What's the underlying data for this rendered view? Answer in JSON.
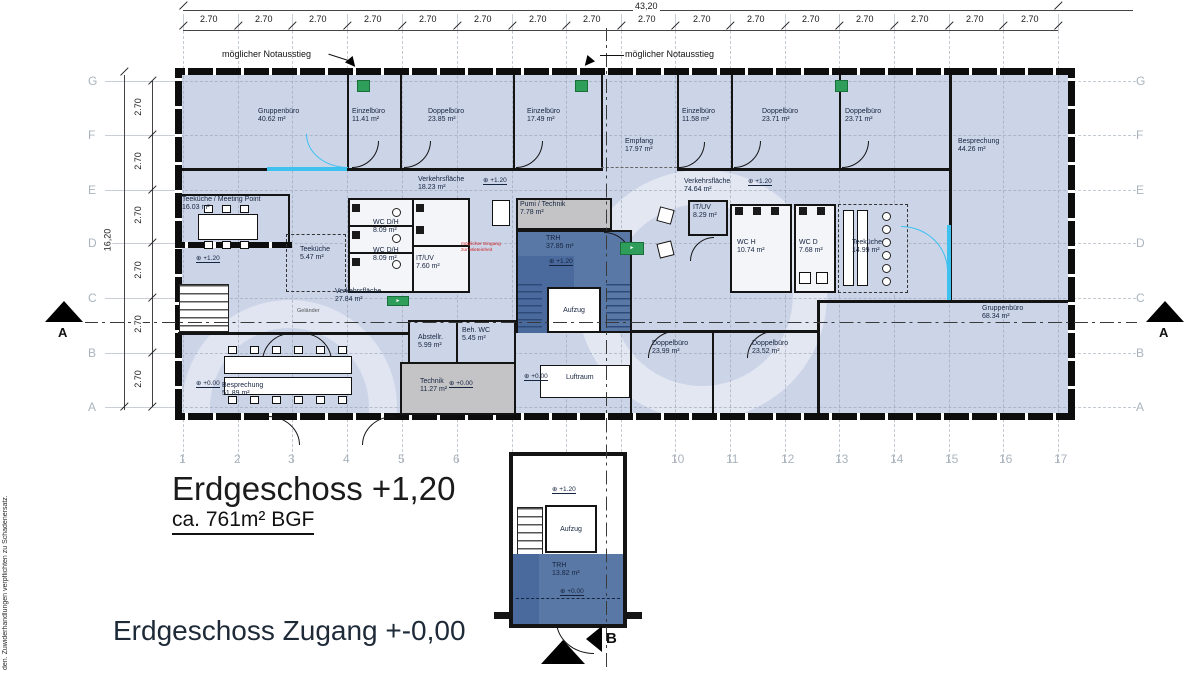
{
  "document": {
    "floor_title": "Erdgeschoss +1,20",
    "floor_area": "ca. 761m² BGF",
    "access_title": "Erdgeschoss Zugang +-0,00",
    "side_note": "den. Zuwiderhandlungen verpflichten zu Schadenersatz."
  },
  "dimensions": {
    "total_width": "43,20",
    "total_height": "16,20",
    "h_segment": "2.70",
    "h_segment_centers": [
      210,
      265,
      319,
      374,
      429,
      484,
      539,
      593,
      648,
      703,
      757,
      812,
      866,
      921,
      976,
      1031
    ],
    "v_segment": "2.70",
    "v_segment_centers": [
      108,
      162,
      216,
      271,
      325,
      380
    ]
  },
  "grid": {
    "cols": [
      {
        "label": "1",
        "x": 183
      },
      {
        "label": "2",
        "x": 238
      },
      {
        "label": "3",
        "x": 292
      },
      {
        "label": "4",
        "x": 347
      },
      {
        "label": "5",
        "x": 402
      },
      {
        "label": "6",
        "x": 457
      },
      {
        "label": "",
        "x": 512
      },
      {
        "label": "",
        "x": 566
      },
      {
        "label": "",
        "x": 621
      },
      {
        "label": "10",
        "x": 675
      },
      {
        "label": "11",
        "x": 730
      },
      {
        "label": "12",
        "x": 785
      },
      {
        "label": "13",
        "x": 839
      },
      {
        "label": "14",
        "x": 894
      },
      {
        "label": "15",
        "x": 949
      },
      {
        "label": "16",
        "x": 1003
      },
      {
        "label": "17",
        "x": 1058
      }
    ],
    "rows": [
      {
        "label": "G",
        "y": 81
      },
      {
        "label": "F",
        "y": 135
      },
      {
        "label": "E",
        "y": 190
      },
      {
        "label": "D",
        "y": 243
      },
      {
        "label": "C",
        "y": 298
      },
      {
        "label": "B",
        "y": 353
      },
      {
        "label": "A",
        "y": 407
      }
    ]
  },
  "annotations": {
    "emergency_exit": "möglicher Notausstieg",
    "entrance_note": "möglicher Eingang zur Mieteinheit",
    "railing": "Geländer"
  },
  "labels": {
    "elevator": "Aufzug"
  },
  "section_markers": {
    "left": "A",
    "right": "A",
    "bottom": "B"
  },
  "rooms": [
    {
      "name": "Gruppenbüro",
      "area": "40.62 m²",
      "x": 258,
      "y": 108
    },
    {
      "name": "Einzelbüro",
      "area": "11.41 m²",
      "x": 352,
      "y": 108
    },
    {
      "name": "Doppelbüro",
      "area": "23.85 m²",
      "x": 428,
      "y": 108
    },
    {
      "name": "Einzelbüro",
      "area": "17.49 m²",
      "x": 527,
      "y": 108
    },
    {
      "name": "Empfang",
      "area": "17.97 m²",
      "x": 625,
      "y": 138
    },
    {
      "name": "Einzelbüro",
      "area": "11.58 m²",
      "x": 682,
      "y": 108
    },
    {
      "name": "Doppelbüro",
      "area": "23.71 m²",
      "x": 762,
      "y": 108
    },
    {
      "name": "Doppelbüro",
      "area": "23.71 m²",
      "x": 845,
      "y": 108
    },
    {
      "name": "Besprechung",
      "area": "44.26 m²",
      "x": 958,
      "y": 138
    },
    {
      "name": "Verkehrsfläche",
      "area": "18.23 m²",
      "x": 418,
      "y": 176
    },
    {
      "name": "Verkehrsfläche",
      "area": "74.64 m²",
      "x": 684,
      "y": 178
    },
    {
      "name": "Teeküche / Meeting Point",
      "area": "16.03 m²",
      "x": 182,
      "y": 196
    },
    {
      "name": "Teeküche",
      "area": "5.47 m²",
      "x": 300,
      "y": 246
    },
    {
      "name": "WC D/H",
      "area": "8.09 m²",
      "x": 373,
      "y": 219
    },
    {
      "name": "WC D/H",
      "area": "8.09 m²",
      "x": 373,
      "y": 247
    },
    {
      "name": "IT/UV",
      "area": "7.60 m²",
      "x": 416,
      "y": 255
    },
    {
      "name": "Pumi / Technik",
      "area": "7.78 m²",
      "x": 520,
      "y": 201
    },
    {
      "name": "TRH",
      "area": "37.85 m²",
      "x": 546,
      "y": 235
    },
    {
      "name": "IT/UV",
      "area": "8.29 m²",
      "x": 693,
      "y": 204
    },
    {
      "name": "WC H",
      "area": "10.74 m²",
      "x": 737,
      "y": 239
    },
    {
      "name": "WC D",
      "area": "7.68 m²",
      "x": 799,
      "y": 239
    },
    {
      "name": "Teeküche",
      "area": "14.99 m²",
      "x": 852,
      "y": 239
    },
    {
      "name": "Verkehrsfläche",
      "area": "27.84 m²",
      "x": 335,
      "y": 288
    },
    {
      "name": "Gruppenbüro",
      "area": "68.34 m²",
      "x": 982,
      "y": 305
    },
    {
      "name": "Abstellr.",
      "area": "5.99 m²",
      "x": 418,
      "y": 334
    },
    {
      "name": "Beh. WC",
      "area": "5.45 m²",
      "x": 462,
      "y": 327
    },
    {
      "name": "Doppelbüro",
      "area": "23.99 m²",
      "x": 652,
      "y": 340
    },
    {
      "name": "Doppelbüro",
      "area": "23.52 m²",
      "x": 752,
      "y": 340
    },
    {
      "name": "Besprechung",
      "area": "51.89 m²",
      "x": 222,
      "y": 382
    },
    {
      "name": "Technik",
      "area": "11.27 m²",
      "x": 420,
      "y": 378
    },
    {
      "name": "Luftraum",
      "area": "",
      "x": 566,
      "y": 374
    },
    {
      "name": "TRH",
      "area": "13.82 m²",
      "x": 552,
      "y": 562
    }
  ],
  "level_markers": [
    {
      "label": "+1.20",
      "x": 483,
      "y": 176
    },
    {
      "label": "+1.20",
      "x": 748,
      "y": 177
    },
    {
      "label": "+1.20",
      "x": 196,
      "y": 254
    },
    {
      "label": "+1.20",
      "x": 549,
      "y": 257
    },
    {
      "label": "+0.00",
      "x": 196,
      "y": 379
    },
    {
      "label": "+0.00",
      "x": 449,
      "y": 379
    },
    {
      "label": "+0.00",
      "x": 524,
      "y": 372
    },
    {
      "label": "+1.20",
      "x": 552,
      "y": 485
    },
    {
      "label": "+0.00",
      "x": 560,
      "y": 587
    }
  ],
  "exit_signs": [
    {
      "x": 357,
      "y": 80,
      "w": 13,
      "h": 12,
      "glyph": ""
    },
    {
      "x": 575,
      "y": 80,
      "w": 13,
      "h": 12,
      "glyph": ""
    },
    {
      "x": 835,
      "y": 80,
      "w": 13,
      "h": 12,
      "glyph": ""
    },
    {
      "x": 387,
      "y": 296,
      "w": 22,
      "h": 10,
      "glyph": "►"
    },
    {
      "x": 620,
      "y": 242,
      "w": 24,
      "h": 13,
      "glyph": "►"
    }
  ],
  "colors": {
    "room_fill": "#ccd4e8",
    "stair_fill": "#5a78a6",
    "stair_dark": "#4a699d",
    "tech_fill": "#c4c4c7",
    "accent_cyan": "#3ec1ef",
    "exit_green": "#2f9e5a",
    "label_text": "#15243f"
  }
}
